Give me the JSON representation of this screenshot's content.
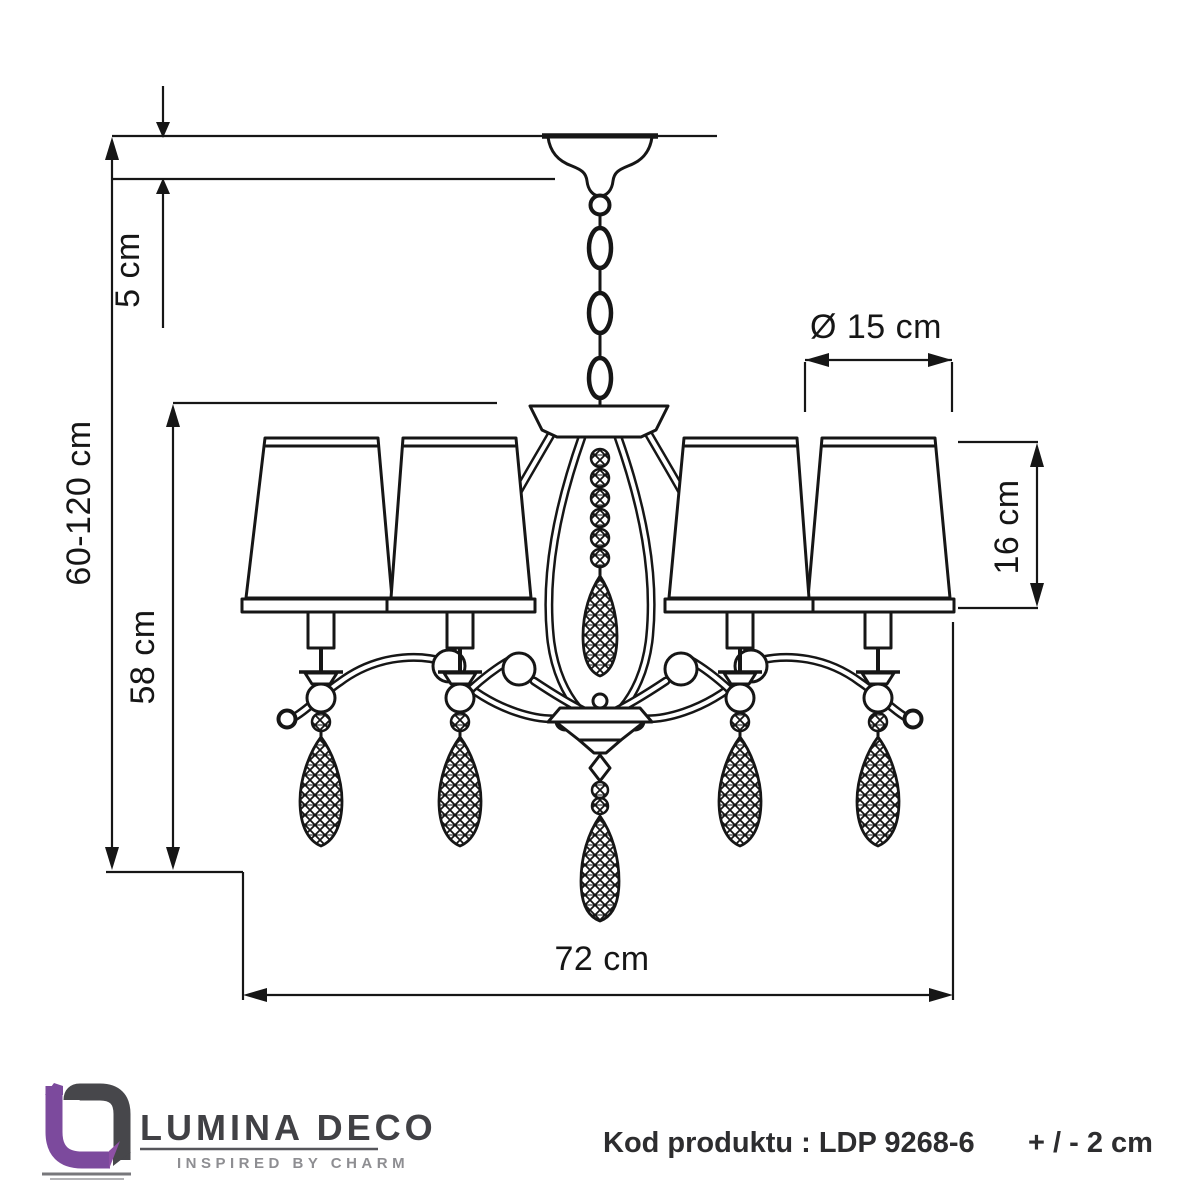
{
  "diagram": {
    "title": "chandelier-dimension-drawing",
    "dimensions": {
      "ceiling_offset": "5 cm",
      "hanging_height": "60-120 cm",
      "body_height": "58 cm",
      "shade_diameter": "Ø 15 cm",
      "shade_height": "16 cm",
      "total_width": "72 cm"
    }
  },
  "brand": {
    "name": "LUMINA DECO",
    "tagline": "INSPIRED BY CHARM"
  },
  "footer": {
    "product_code": "Kod produktu : LDP 9268-6",
    "tolerance": "+ / - 2 cm"
  },
  "colors": {
    "line": "#161616",
    "brand_purple": "#7c4a9d",
    "brand_dark": "#47474b",
    "brand_gray": "#8e8e92",
    "text": "#2d2d2f"
  }
}
